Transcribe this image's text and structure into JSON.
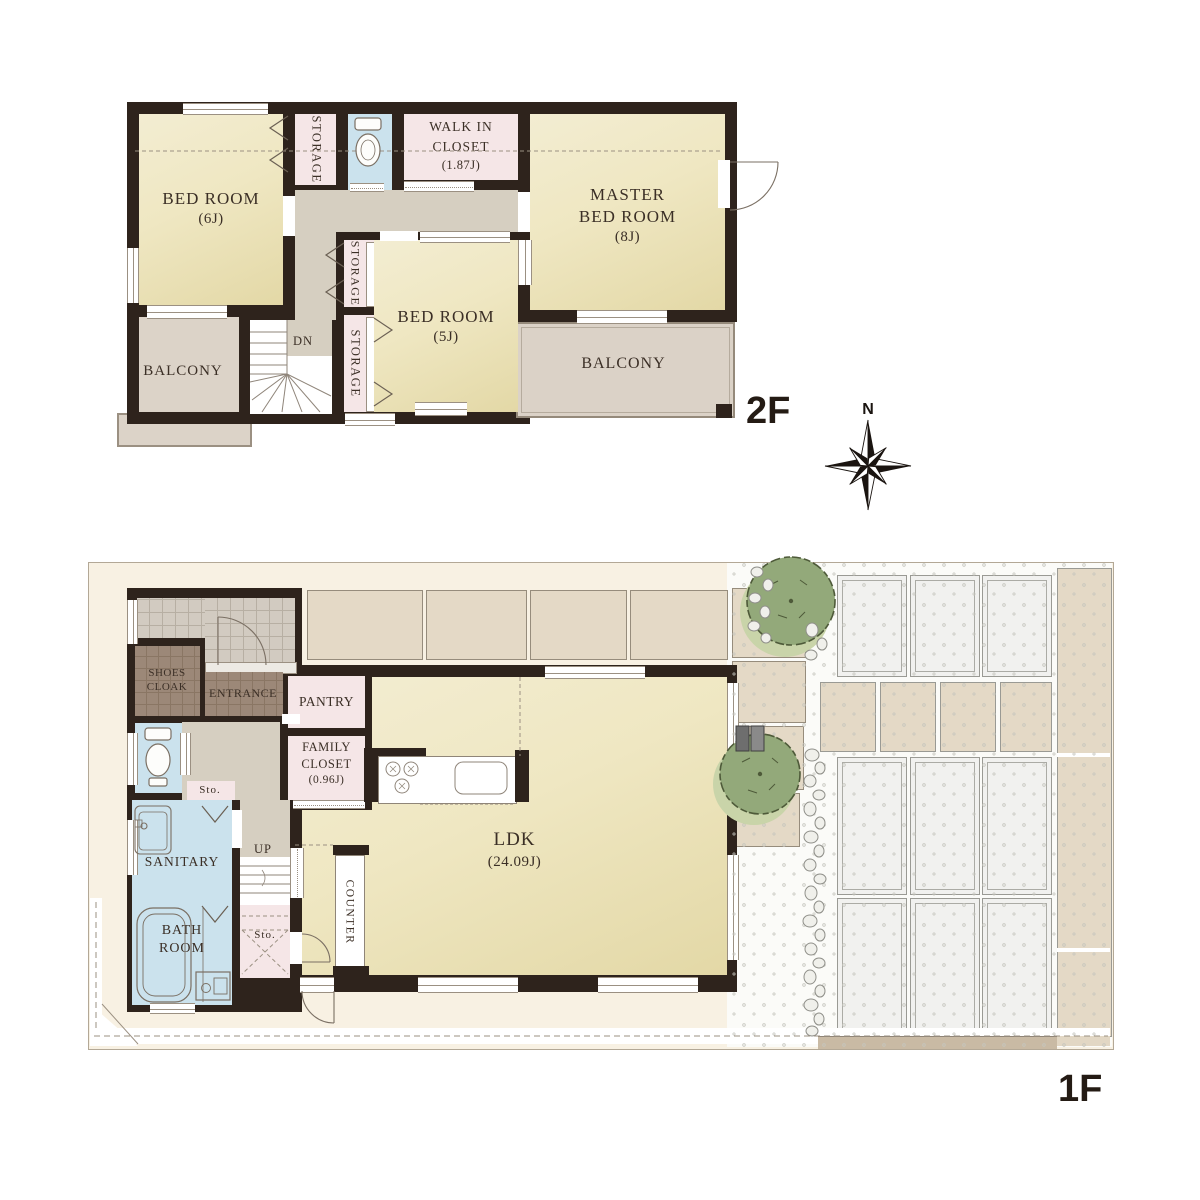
{
  "palette": {
    "wall": "#2E231C",
    "room_yellow": "#EFE7C2",
    "closet_pink": "#F5E6E7",
    "wet_area_blue": "#CBE2ED",
    "hall_gray": "#D6CFC1",
    "balcony_tan": "#DBD2C7",
    "site_cream": "#F8F1E3",
    "tile_brown": "#9C8878",
    "paver_tan": "#E4D9C6",
    "tree_green": "#93A97A",
    "label_brown": "#3B2F26"
  },
  "compass": {
    "north_label": "N"
  },
  "floor2": {
    "floor_label": "2F",
    "bedroom6": {
      "name": "BED ROOM",
      "size": "(6J)"
    },
    "storage_top": {
      "name": "STORAGE"
    },
    "walk_in_closet": {
      "line1": "WALK IN",
      "line2": "CLOSET",
      "size": "(1.87J)"
    },
    "master_bedroom": {
      "line1": "MASTER",
      "line2": "BED ROOM",
      "size": "(8J)"
    },
    "bedroom5": {
      "name": "BED ROOM",
      "size": "(5J)"
    },
    "storage_mid": {
      "name": "STORAGE"
    },
    "storage_low": {
      "name": "STORAGE"
    },
    "balcony_left": {
      "name": "BALCONY"
    },
    "balcony_right": {
      "name": "BALCONY"
    },
    "stairs": {
      "label": "DN"
    }
  },
  "floor1": {
    "floor_label": "1F",
    "shoes_cloak": {
      "line1": "SHOES",
      "line2": "CLOAK"
    },
    "entrance": {
      "name": "ENTRANCE"
    },
    "pantry": {
      "name": "PANTRY"
    },
    "family_closet": {
      "line1": "FAMILY",
      "line2": "CLOSET",
      "size": "(0.96J)"
    },
    "sanitary": {
      "name": "SANITARY"
    },
    "bathroom": {
      "line1": "BATH",
      "line2": "ROOM"
    },
    "ldk": {
      "name": "LDK",
      "size": "(24.09J)"
    },
    "counter": {
      "name": "COUNTER"
    },
    "stairs": {
      "label": "UP"
    },
    "storage_small_upper": {
      "name": "Sto."
    },
    "storage_small_lower": {
      "name": "Sto."
    }
  }
}
